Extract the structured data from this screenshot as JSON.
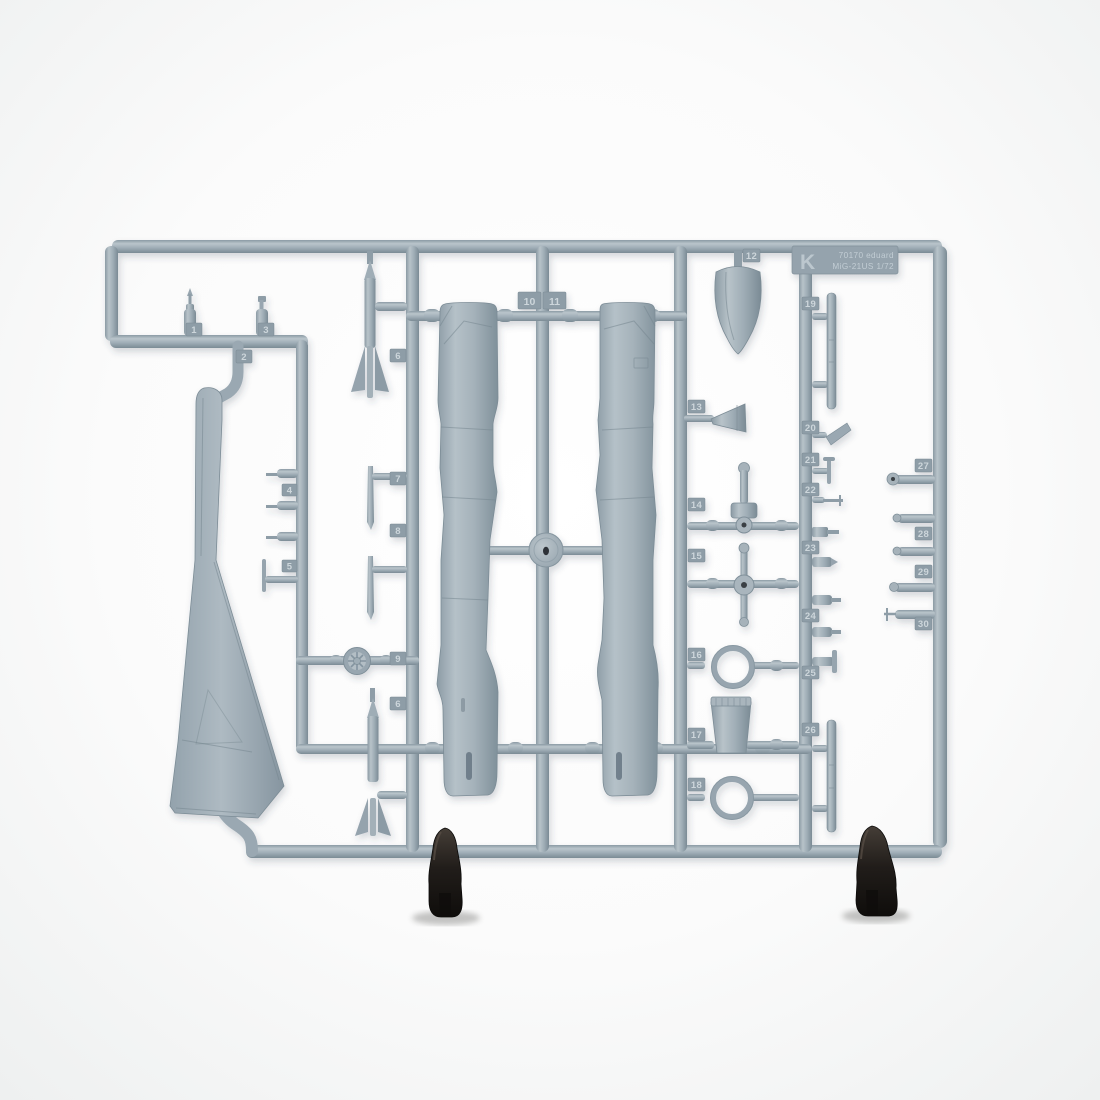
{
  "colors": {
    "background": "#fbfbfb",
    "plastic": "#9fadb6",
    "plastic_light": "#c6cfd4",
    "plastic_dark": "#7e8e98",
    "tag_plate": "#8e9da7",
    "emboss_text": "#ccd5da",
    "clip": "#211d1a"
  },
  "sprue_plate": {
    "letter": "K",
    "line1": "70170 eduard",
    "line2": "MiG-21US 1/72"
  },
  "tags": {
    "n1": "1",
    "n2": "2",
    "n3": "3",
    "n4": "4",
    "n5": "5",
    "n6": "6",
    "n7": "7",
    "n8": "8",
    "n9": "9",
    "n10": "10",
    "n11": "11",
    "n12": "12",
    "n13": "13",
    "n14": "14",
    "n15": "15",
    "n16": "16",
    "n17": "17",
    "n18": "18",
    "n19": "19",
    "n20": "20",
    "n21": "21",
    "n22": "22",
    "n23": "23",
    "n24": "24",
    "n25": "25",
    "n26": "26",
    "n27": "27",
    "n28": "28",
    "n29": "29",
    "n30": "30"
  }
}
